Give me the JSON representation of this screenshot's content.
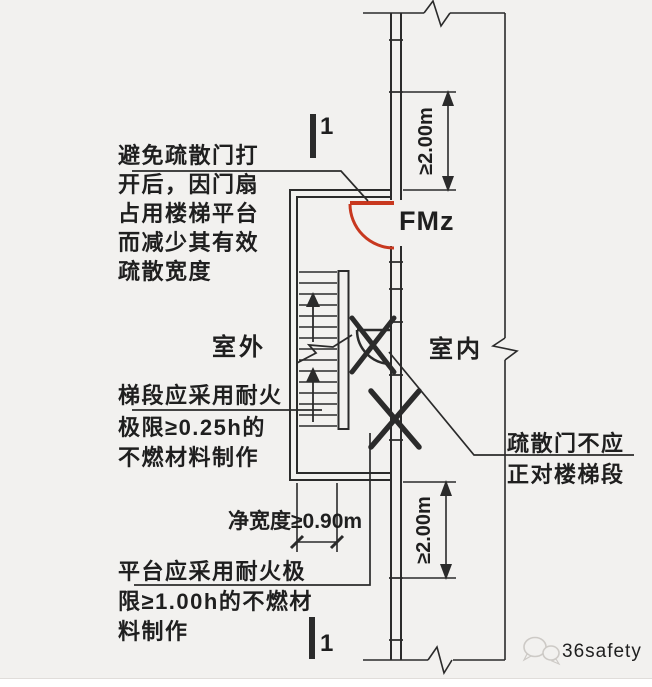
{
  "colors": {
    "background": "#f2f1ef",
    "line": "#2b2b2b",
    "door_red": "#c8381f",
    "watermark": "#c9c6c2"
  },
  "labels": {
    "outdoor": "室外",
    "indoor": "室内",
    "fire_door_code": "FMz",
    "section_top": "1",
    "section_bottom": "1"
  },
  "annotations": {
    "door_swing": {
      "line1": "避免疏散门打",
      "line2": "开后，因门扇",
      "line3": "占用楼梯平台",
      "line4": "而减少其有效",
      "line5": "疏散宽度"
    },
    "stair_fire": {
      "line1": "梯段应采用耐火",
      "line2": "极限≥0.25h的",
      "line3": "不燃材料制作"
    },
    "platform_fire": {
      "line1": "平台应采用耐火极",
      "line2": "限≥1.00h的不燃材",
      "line3": "料制作"
    },
    "door_facing": {
      "line1": "疏散门不应",
      "line2": "正对楼梯段"
    }
  },
  "dimensions": {
    "upper_clearance": "≥2.00m",
    "lower_clearance": "≥2.00m",
    "stair_width": "净宽度≥0.90m"
  },
  "watermark": {
    "brand": "36safety"
  }
}
